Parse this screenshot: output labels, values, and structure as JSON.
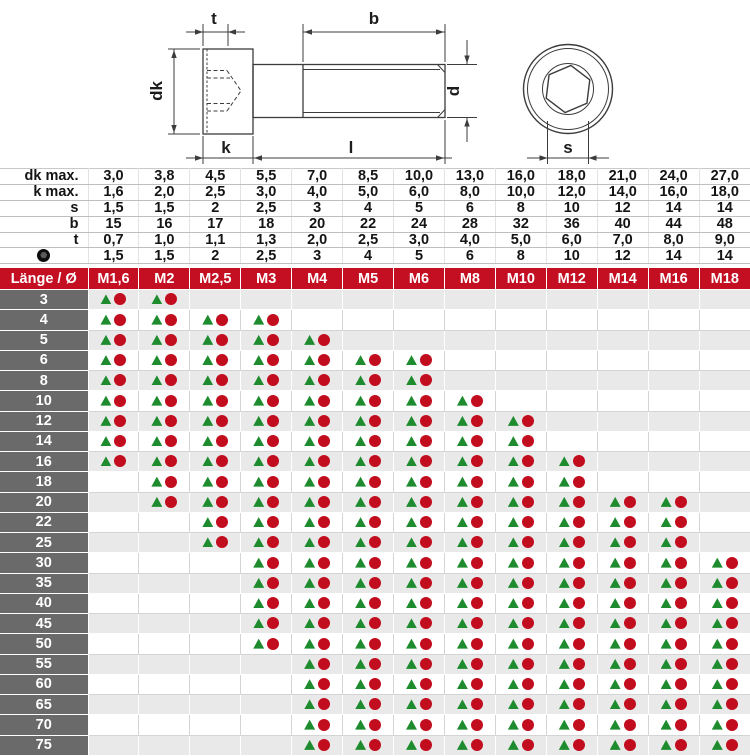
{
  "colors": {
    "header_bg": "#c40f22",
    "length_col_bg": "#6a6a6a",
    "alt_row_bg": "#e9e9e9",
    "triangle_green": "#1e8c2e",
    "circle_red": "#c20d1f"
  },
  "drawing": {
    "labels": {
      "t": "t",
      "b": "b",
      "dk": "dk",
      "d": "d",
      "k": "k",
      "l": "l",
      "s": "s"
    }
  },
  "spec_table": {
    "rows": [
      {
        "label": "dk max.",
        "values": [
          "3,0",
          "3,8",
          "4,5",
          "5,5",
          "7,0",
          "8,5",
          "10,0",
          "13,0",
          "16,0",
          "18,0",
          "21,0",
          "24,0",
          "27,0"
        ]
      },
      {
        "label": "k max.",
        "values": [
          "1,6",
          "2,0",
          "2,5",
          "3,0",
          "4,0",
          "5,0",
          "6,0",
          "8,0",
          "10,0",
          "12,0",
          "14,0",
          "16,0",
          "18,0"
        ]
      },
      {
        "label": "s",
        "values": [
          "1,5",
          "1,5",
          "2",
          "2,5",
          "3",
          "4",
          "5",
          "6",
          "8",
          "10",
          "12",
          "14",
          "14"
        ]
      },
      {
        "label": "b",
        "values": [
          "15",
          "16",
          "17",
          "18",
          "20",
          "22",
          "24",
          "28",
          "32",
          "36",
          "40",
          "44",
          "48"
        ]
      },
      {
        "label": "t",
        "values": [
          "0,7",
          "1,0",
          "1,1",
          "1,3",
          "2,0",
          "2,5",
          "3,0",
          "4,0",
          "5,0",
          "6,0",
          "7,0",
          "8,0",
          "9,0"
        ]
      },
      {
        "label": "",
        "icon": "hex-socket-icon",
        "values": [
          "1,5",
          "1,5",
          "2",
          "2,5",
          "3",
          "4",
          "5",
          "6",
          "8",
          "10",
          "12",
          "14",
          "14"
        ]
      }
    ]
  },
  "matrix": {
    "corner": "Länge / Ø",
    "sizes": [
      "M1,6",
      "M2",
      "M2,5",
      "M3",
      "M4",
      "M5",
      "M6",
      "M8",
      "M10",
      "M12",
      "M14",
      "M16",
      "M18"
    ],
    "markers": {
      "triangle": "green-triangle",
      "circle": "red-circle"
    },
    "rows": [
      {
        "length": "3",
        "available": [
          "M1,6",
          "M2"
        ]
      },
      {
        "length": "4",
        "available": [
          "M1,6",
          "M2",
          "M2,5",
          "M3"
        ]
      },
      {
        "length": "5",
        "available": [
          "M1,6",
          "M2",
          "M2,5",
          "M3",
          "M4"
        ]
      },
      {
        "length": "6",
        "available": [
          "M1,6",
          "M2",
          "M2,5",
          "M3",
          "M4",
          "M5",
          "M6"
        ]
      },
      {
        "length": "8",
        "available": [
          "M1,6",
          "M2",
          "M2,5",
          "M3",
          "M4",
          "M5",
          "M6"
        ]
      },
      {
        "length": "10",
        "available": [
          "M1,6",
          "M2",
          "M2,5",
          "M3",
          "M4",
          "M5",
          "M6",
          "M8"
        ]
      },
      {
        "length": "12",
        "available": [
          "M1,6",
          "M2",
          "M2,5",
          "M3",
          "M4",
          "M5",
          "M6",
          "M8",
          "M10"
        ]
      },
      {
        "length": "14",
        "available": [
          "M1,6",
          "M2",
          "M2,5",
          "M3",
          "M4",
          "M5",
          "M6",
          "M8",
          "M10"
        ]
      },
      {
        "length": "16",
        "available": [
          "M1,6",
          "M2",
          "M2,5",
          "M3",
          "M4",
          "M5",
          "M6",
          "M8",
          "M10",
          "M12"
        ]
      },
      {
        "length": "18",
        "available": [
          "M2",
          "M2,5",
          "M3",
          "M4",
          "M5",
          "M6",
          "M8",
          "M10",
          "M12"
        ]
      },
      {
        "length": "20",
        "available": [
          "M2",
          "M2,5",
          "M3",
          "M4",
          "M5",
          "M6",
          "M8",
          "M10",
          "M12",
          "M14",
          "M16"
        ]
      },
      {
        "length": "22",
        "available": [
          "M2,5",
          "M3",
          "M4",
          "M5",
          "M6",
          "M8",
          "M10",
          "M12",
          "M14",
          "M16"
        ]
      },
      {
        "length": "25",
        "available": [
          "M2,5",
          "M3",
          "M4",
          "M5",
          "M6",
          "M8",
          "M10",
          "M12",
          "M14",
          "M16"
        ]
      },
      {
        "length": "30",
        "available": [
          "M3",
          "M4",
          "M5",
          "M6",
          "M8",
          "M10",
          "M12",
          "M14",
          "M16",
          "M18"
        ]
      },
      {
        "length": "35",
        "available": [
          "M3",
          "M4",
          "M5",
          "M6",
          "M8",
          "M10",
          "M12",
          "M14",
          "M16",
          "M18"
        ]
      },
      {
        "length": "40",
        "available": [
          "M3",
          "M4",
          "M5",
          "M6",
          "M8",
          "M10",
          "M12",
          "M14",
          "M16",
          "M18"
        ]
      },
      {
        "length": "45",
        "available": [
          "M3",
          "M4",
          "M5",
          "M6",
          "M8",
          "M10",
          "M12",
          "M14",
          "M16",
          "M18"
        ]
      },
      {
        "length": "50",
        "available": [
          "M3",
          "M4",
          "M5",
          "M6",
          "M8",
          "M10",
          "M12",
          "M14",
          "M16",
          "M18"
        ]
      },
      {
        "length": "55",
        "available": [
          "M4",
          "M5",
          "M6",
          "M8",
          "M10",
          "M12",
          "M14",
          "M16",
          "M18"
        ]
      },
      {
        "length": "60",
        "available": [
          "M4",
          "M5",
          "M6",
          "M8",
          "M10",
          "M12",
          "M14",
          "M16",
          "M18"
        ]
      },
      {
        "length": "65",
        "available": [
          "M4",
          "M5",
          "M6",
          "M8",
          "M10",
          "M12",
          "M14",
          "M16",
          "M18"
        ]
      },
      {
        "length": "70",
        "available": [
          "M4",
          "M5",
          "M6",
          "M8",
          "M10",
          "M12",
          "M14",
          "M16",
          "M18"
        ]
      },
      {
        "length": "75",
        "available": [
          "M4",
          "M5",
          "M6",
          "M8",
          "M10",
          "M12",
          "M14",
          "M16",
          "M18"
        ]
      }
    ]
  }
}
